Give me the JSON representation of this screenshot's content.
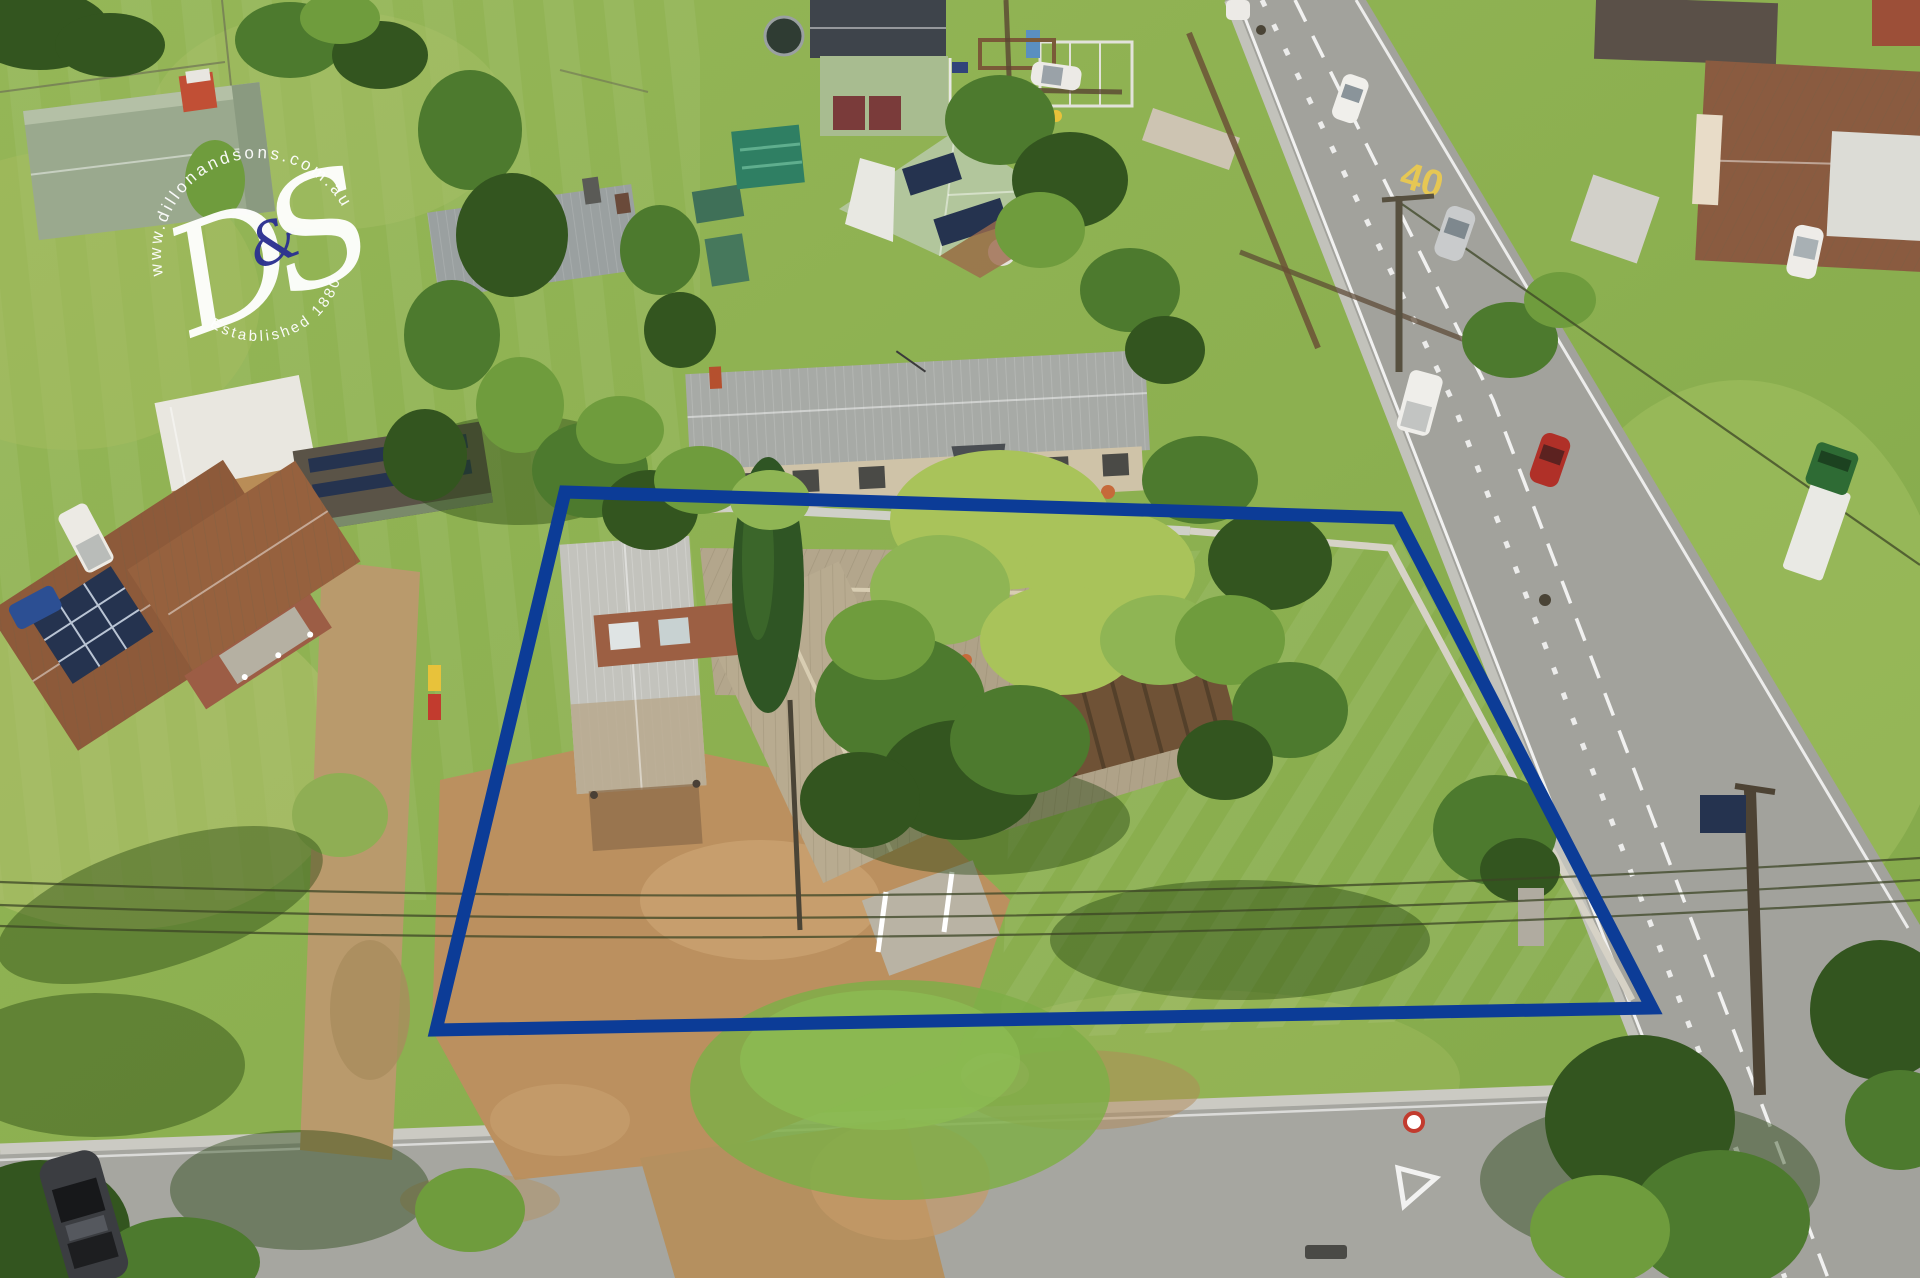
{
  "watermark": {
    "site_url_arc": "www.dillonandsons.com.au",
    "monogram_d": "D",
    "monogram_amp": "&",
    "monogram_s": "S",
    "established_arc": "Established 1880"
  },
  "road_markings": {
    "speed_limit": "40"
  },
  "boundary": {
    "points": "565,492 1398,518 1652,1008 436,1030",
    "stroke_width": 13
  },
  "colors": {
    "boundary-blue": "#0c3c97",
    "watermark-white": "#ffffff",
    "watermark-navy": "#2b3190",
    "road-marking-yellow": "#eccb4e",
    "grass-base": "#8cb050",
    "asphalt": "#a2a29c",
    "dirt-tan": "#bb905f",
    "subject-roof-tan": "#b3a68c",
    "neighbor-roof-terracotta": "#8d5a3a",
    "rear-roof-gray": "#a7aaa6",
    "sage-roof": "#b2c69c",
    "solar-navy": "#25334f"
  }
}
